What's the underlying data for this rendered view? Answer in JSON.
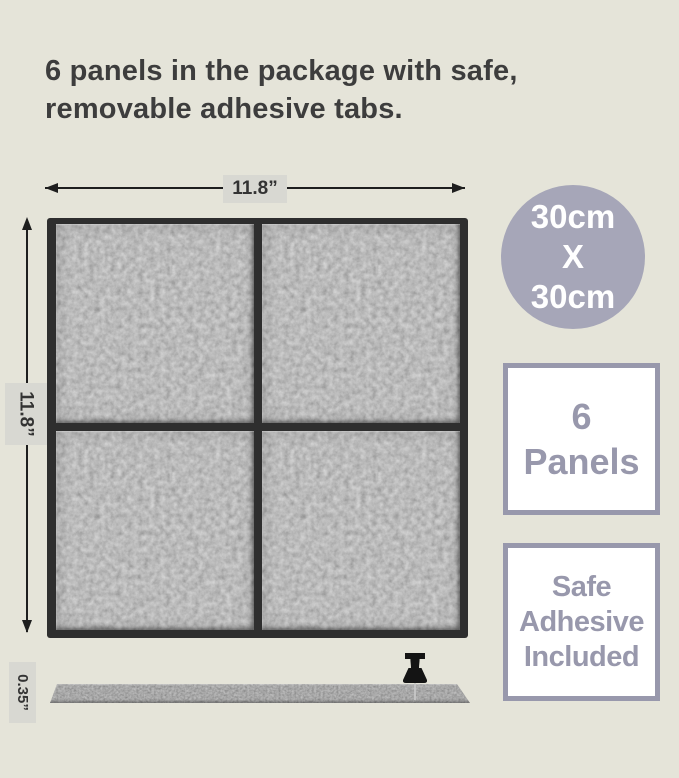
{
  "headline": {
    "line1": "6 panels in the package with safe,",
    "line2": "removable adhesive tabs."
  },
  "dimensions": {
    "width": {
      "label": "11.8”"
    },
    "height": {
      "label": "11.8”"
    },
    "thickness": {
      "label": "0.35”"
    }
  },
  "size_badge": {
    "line1": "30cm",
    "line2": "X",
    "line3": "30cm"
  },
  "count_badge": {
    "line1": "6",
    "line2": "Panels"
  },
  "adhesive_badge": {
    "line1": "Safe",
    "line2": "Adhesive",
    "line3": "Included"
  },
  "icons": {
    "pushpin": "pushpin-icon"
  },
  "colors": {
    "page_bg": "#e5e4d9",
    "headline_text": "#3d3d3d",
    "dim_line": "#1e1e1e",
    "dim_label_bg": "#d8d8d2",
    "dim_label_text": "#333333",
    "circle_bg": "#a6a6b8",
    "circle_text": "#ffffff",
    "badge_border": "#9898ac",
    "badge_text": "#9898ac",
    "badge_bg": "#ffffff",
    "panel_edge": "#2e2e2e",
    "pin": "#141414"
  }
}
